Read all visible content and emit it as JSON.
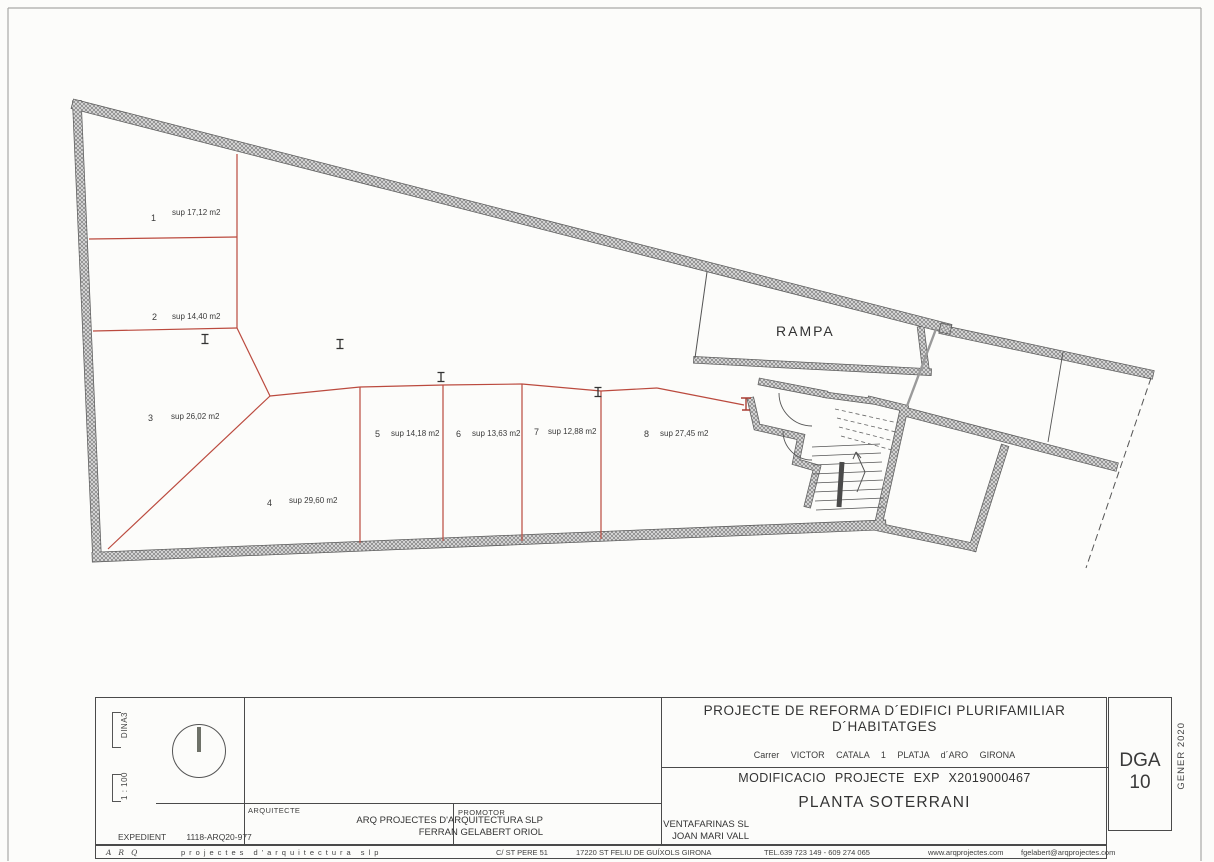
{
  "plan": {
    "ramp_label": "RAMPA",
    "spaces": [
      {
        "num": "1",
        "area": "sup 17,12 m2"
      },
      {
        "num": "2",
        "area": "sup 14,40 m2"
      },
      {
        "num": "3",
        "area": "sup 26,02 m2"
      },
      {
        "num": "4",
        "area": "sup 29,60 m2"
      },
      {
        "num": "5",
        "area": "sup 14,18 m2"
      },
      {
        "num": "6",
        "area": "sup 13,63 m2"
      },
      {
        "num": "7",
        "area": "sup 12,88 m2"
      },
      {
        "num": "8",
        "area": "sup 27,45 m2"
      }
    ],
    "colors": {
      "partition_red": "#bb4a3e",
      "ink": "#3c3c3c",
      "wall_gray": "#d9d9d9"
    }
  },
  "titleblock": {
    "paper": "DINA3",
    "scale": "1 : 100",
    "expedient_label": "EXPEDIENT",
    "expedient_value": "1118-ARQ20-977",
    "arquitecte_label": "ARQUITECTE",
    "arquitecte_line1": "ARQ PROJECTES D'ARQUITECTURA SLP",
    "arquitecte_line2": "FERRAN GELABERT ORIOL",
    "promotor_label": "PROMOTOR",
    "promotor_line1": "VENTAFARINAS SL",
    "promotor_line2": "JOAN MARI VALL",
    "project_line1": "PROJECTE DE REFORMA D´EDIFICI PLURIFAMILIAR",
    "project_line2": "D´HABITATGES",
    "address": "Carrer VICTOR CATALA 1 PLATJA d´ARO GIRONA",
    "modificacio": "MODIFICACIO PROJECTE EXP X2019000467",
    "sheet_title": "PLANTA SOTERRANI",
    "sheet_code": "DGA 10",
    "date": "GENER 2020"
  },
  "footer": {
    "brand_arq": "ARQ",
    "brand_rest": "projectes d'arquitectura slp",
    "address1": "C/ ST PERE 51",
    "address2": "17220 ST FELIU DE GUÍXOLS GIRONA",
    "phone": "TEL.639 723 149 - 609 274 065",
    "web": "www.arqprojectes.com",
    "email": "fgelabert@arqprojectes.com"
  }
}
